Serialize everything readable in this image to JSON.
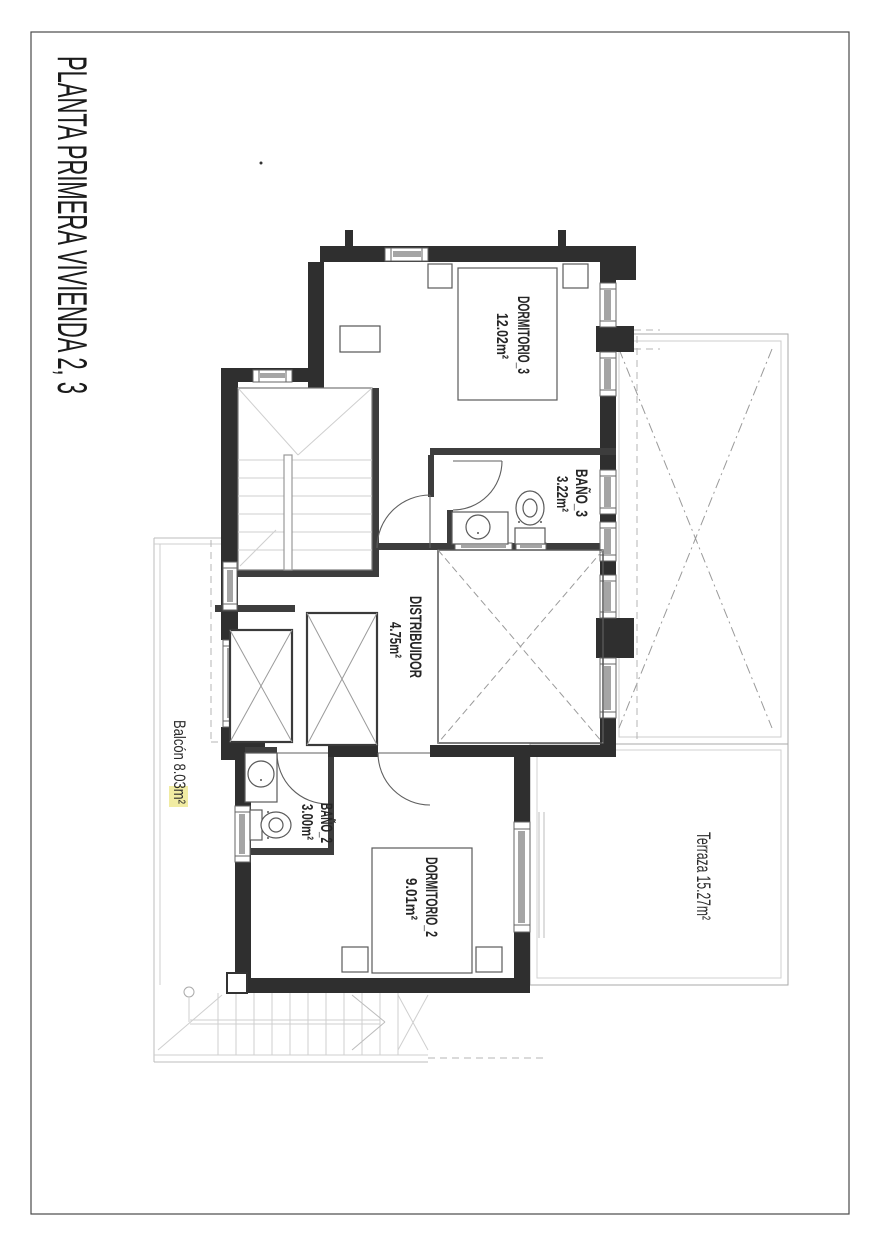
{
  "page": {
    "title": "PLANTA PRIMERA VIVIENDA 2, 3"
  },
  "rooms": {
    "dormitorio3": {
      "name": "DORMITORIO_3",
      "area": "12.02m²"
    },
    "bano3": {
      "name": "BAÑO_3",
      "area": "3.22m²"
    },
    "distribuidor": {
      "name": "DISTRIBUIDOR",
      "area": "4.75m²"
    },
    "bano2": {
      "name": "BAÑO_2",
      "area": "3.00m²"
    },
    "dormitorio2": {
      "name": "DORMITORIO_2",
      "area": "9.01m²"
    }
  },
  "annotations": {
    "terraza": "Terraza 15.27m²",
    "balcon": "Balcón 8.03m²"
  },
  "colors": {
    "wall": "#2f2f2f",
    "light_line": "#bcbcbc",
    "highlight": "#f1eca3",
    "text": "#262626"
  }
}
